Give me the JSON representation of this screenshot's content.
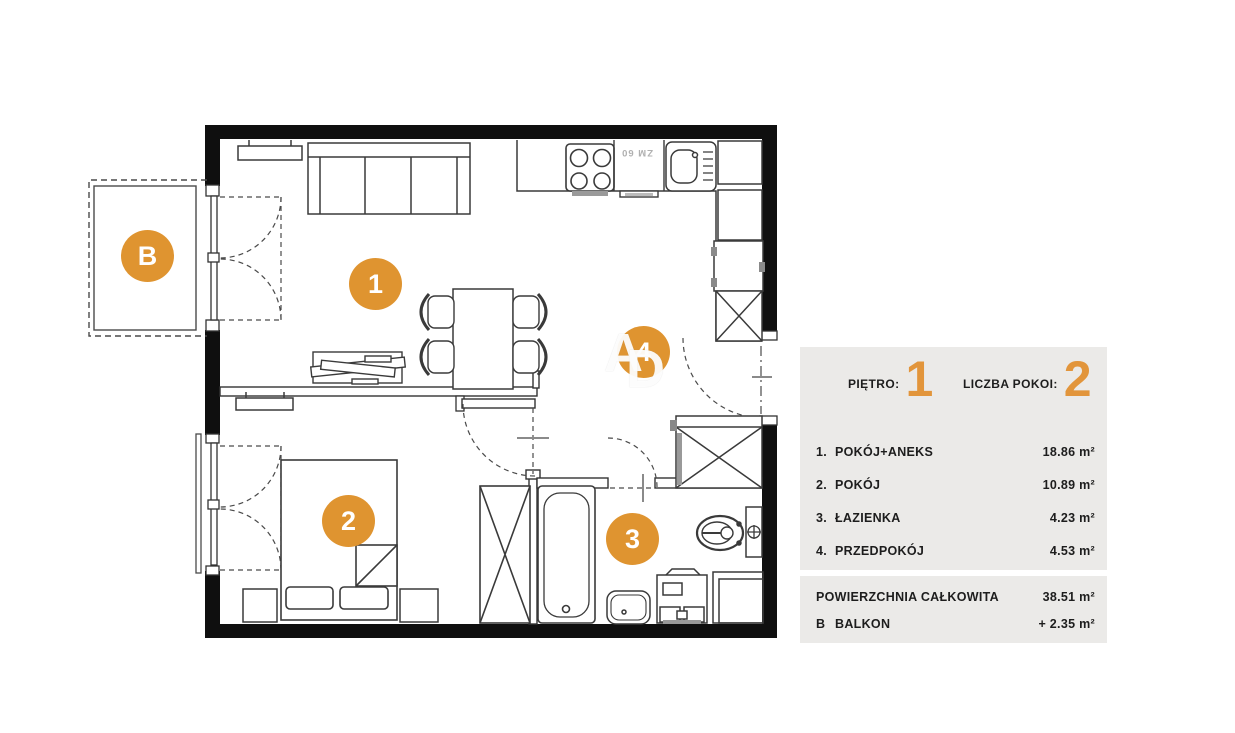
{
  "colors": {
    "accent_orange": "#E2953B",
    "badge_orange": "#DF9430",
    "panel_background": "#EBEAE8",
    "wall_black": "#0f0f0f"
  },
  "plan": {
    "rooms": [
      {
        "id": "B",
        "label": "B"
      },
      {
        "id": "1",
        "label": "1"
      },
      {
        "id": "2",
        "label": "2"
      },
      {
        "id": "3",
        "label": "3"
      },
      {
        "id": "4",
        "label": "4"
      }
    ],
    "kitchen_appliance_label": "ZM 60",
    "watermark_a": "A",
    "watermark_d": "D"
  },
  "legend": {
    "floor_label": "PIĘTRO:",
    "floor_value": "1",
    "rooms_label": "LICZBA POKOI:",
    "rooms_value": "2",
    "rows": [
      {
        "num": "1.",
        "name": "POKÓJ+ANEKS",
        "area": "18.86 m²"
      },
      {
        "num": "2.",
        "name": "POKÓJ",
        "area": "10.89 m²"
      },
      {
        "num": "3.",
        "name": "ŁAZIENKA",
        "area": "4.23 m²"
      },
      {
        "num": "4.",
        "name": "PRZEDPOKÓJ",
        "area": "4.53 m²"
      }
    ],
    "total_label": "POWIERZCHNIA CAŁKOWITA",
    "total_value": "38.51 m²",
    "balcony_letter": "B",
    "balcony_label": "BALKON",
    "balcony_value": "+ 2.35 m²"
  }
}
